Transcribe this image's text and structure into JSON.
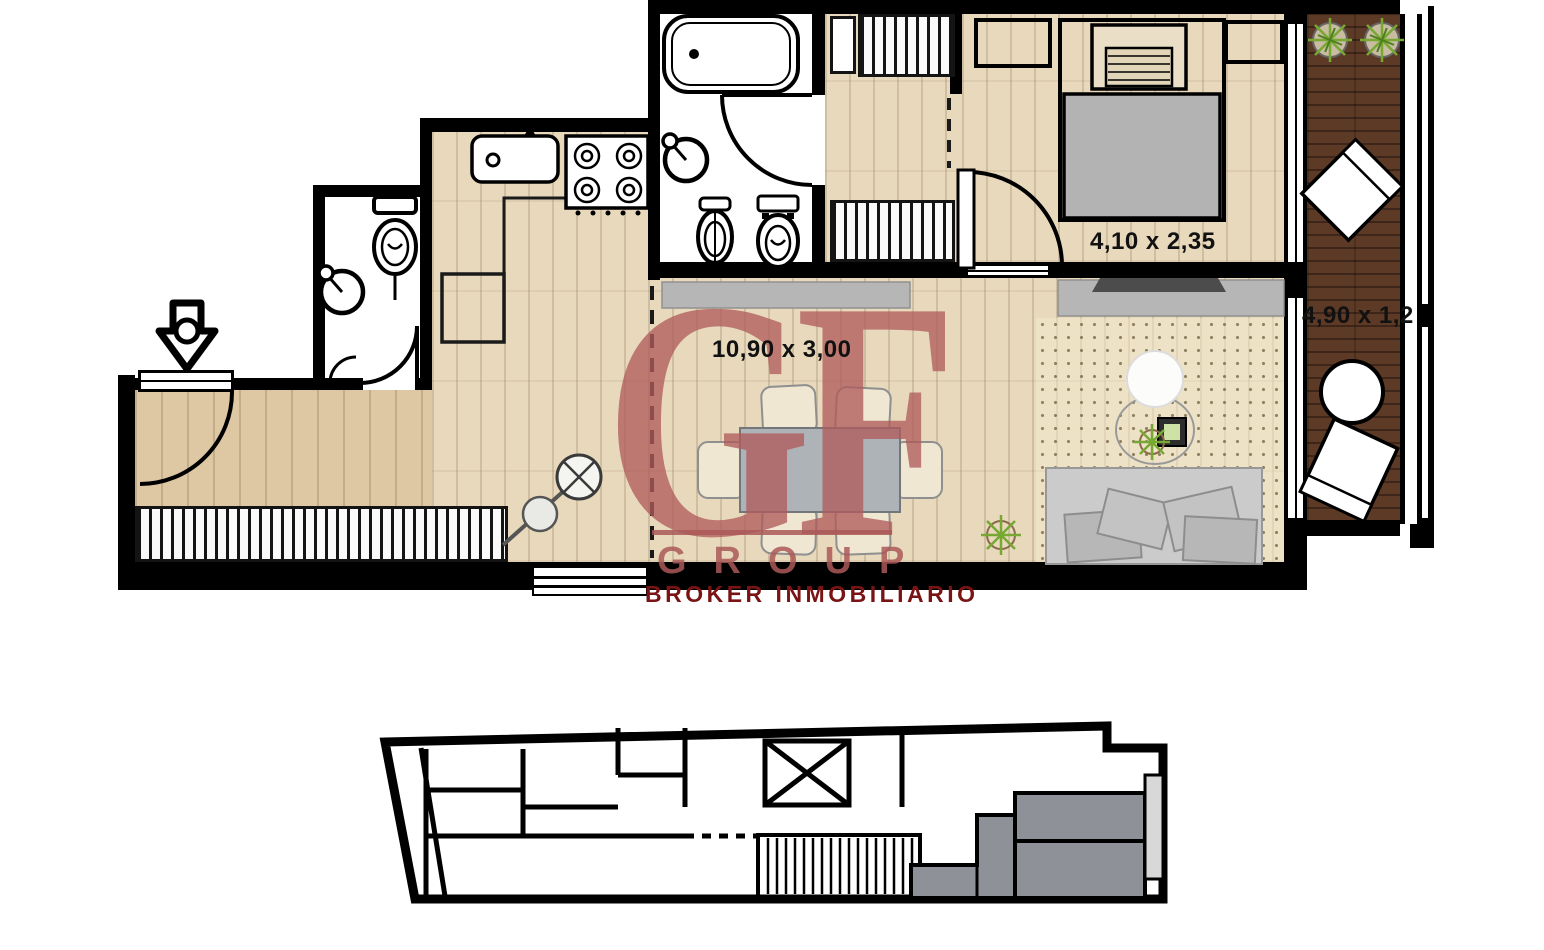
{
  "plan": {
    "labels": {
      "living_dining_dims": "10,90 x 3,00",
      "bedroom_dims": "4,10 x 2,35",
      "balcony_dims": "4,90 x 1,2"
    },
    "watermark": {
      "monogram": "GF",
      "group_text": "GROUP",
      "tagline": "BROKER INMOBILIARIO"
    }
  },
  "theme_colors": {
    "wall": "#000000",
    "wood_floor": "#e8d9bc",
    "wood_floor_entry": "#ddc8a3",
    "balcony_deck": "#5d3a26",
    "fixture_white": "#ffffff",
    "furniture_gray": "#b6b6b6",
    "mattress_gray": "#b3b3b3",
    "watermark_red": "#af5c5c",
    "watermark_dark_red": "#7a1414",
    "plant_green": "#76a832",
    "keyplan_unit_gray": "#8e9298",
    "keyplan_balcony_gray": "#d8d8d8",
    "rug_dot": "#8a795c"
  }
}
